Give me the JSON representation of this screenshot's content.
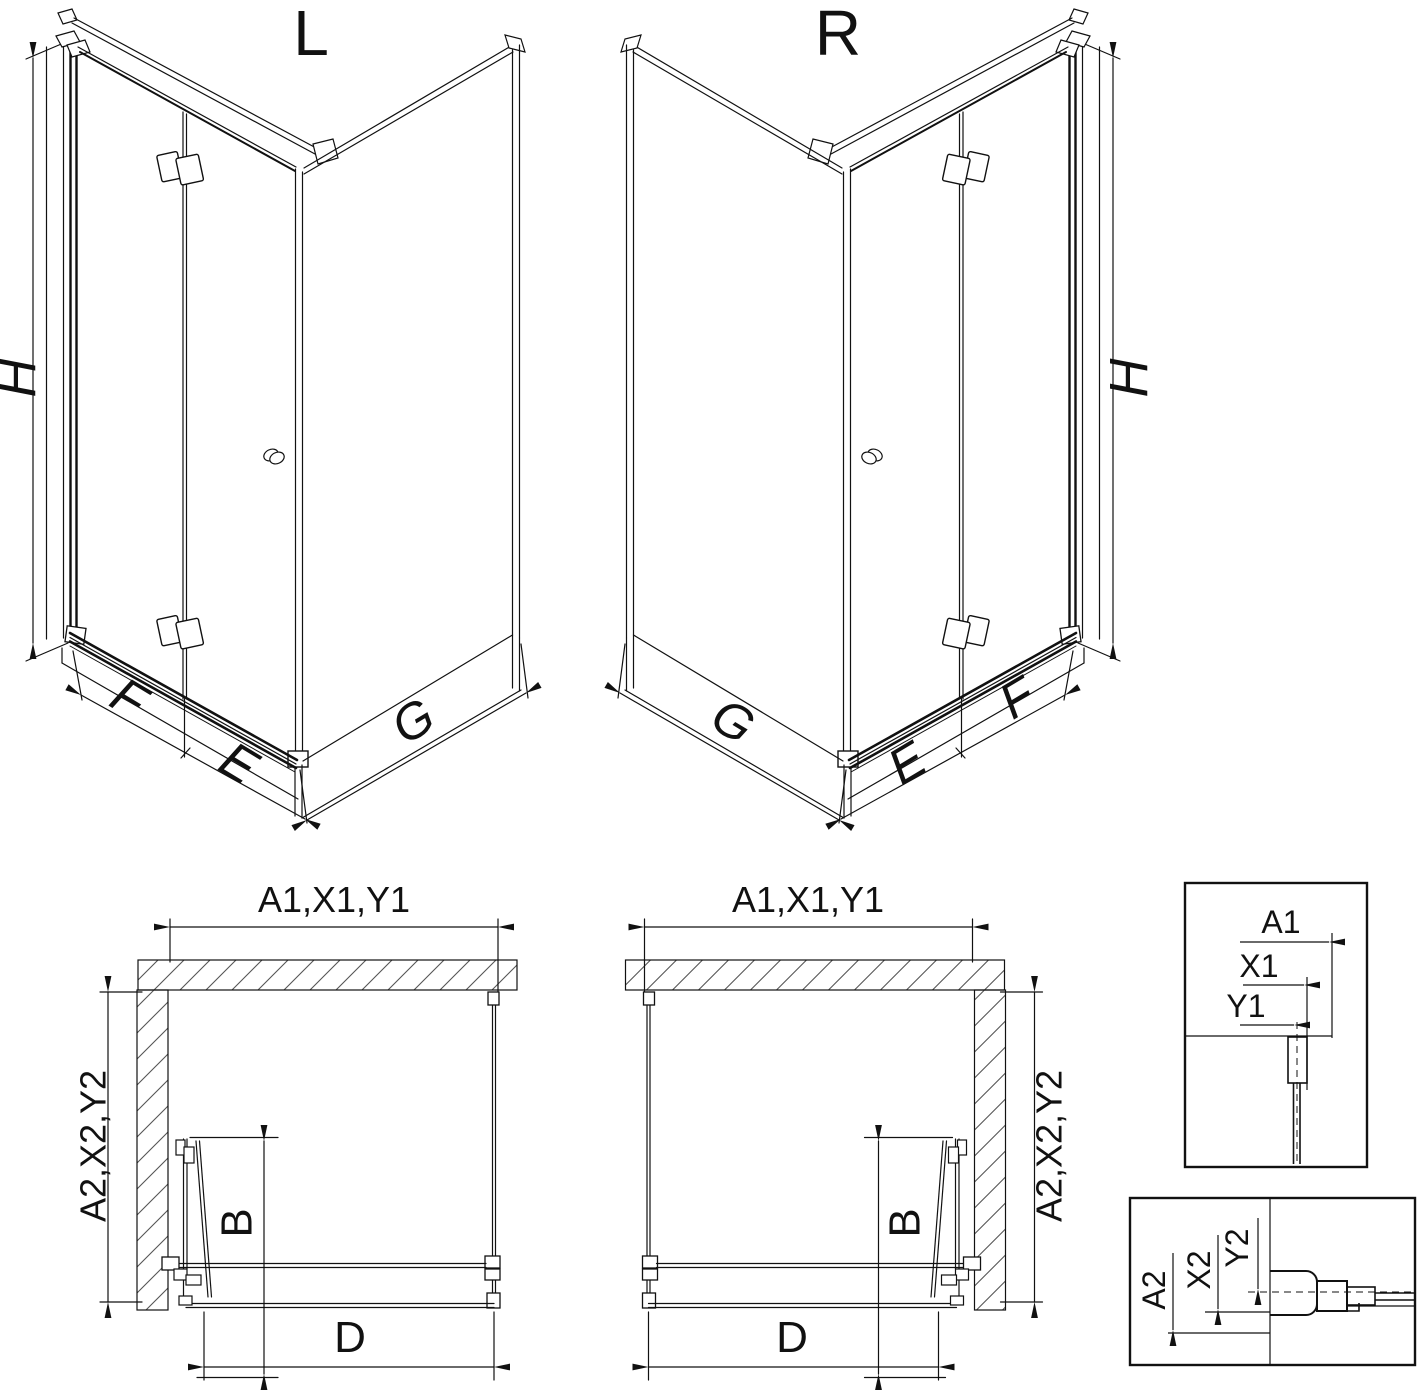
{
  "colors": {
    "line": "#111111",
    "background": "#ffffff"
  },
  "iso_left": {
    "label": "L",
    "h": "H",
    "f": "F",
    "e": "E",
    "g": "G"
  },
  "iso_right": {
    "label": "R",
    "h": "H",
    "f": "F",
    "e": "E",
    "g": "G"
  },
  "plan_left": {
    "top": "A1,X1,Y1",
    "side": "A2,X2,Y2",
    "fold": "B",
    "opening": "D"
  },
  "plan_right": {
    "top": "A1,X1,Y1",
    "side": "A2,X2,Y2",
    "fold": "B",
    "opening": "D"
  },
  "detail_top": {
    "a": "A1",
    "x": "X1",
    "y": "Y1"
  },
  "detail_bottom": {
    "a": "A2",
    "x": "X2",
    "y": "Y2"
  }
}
